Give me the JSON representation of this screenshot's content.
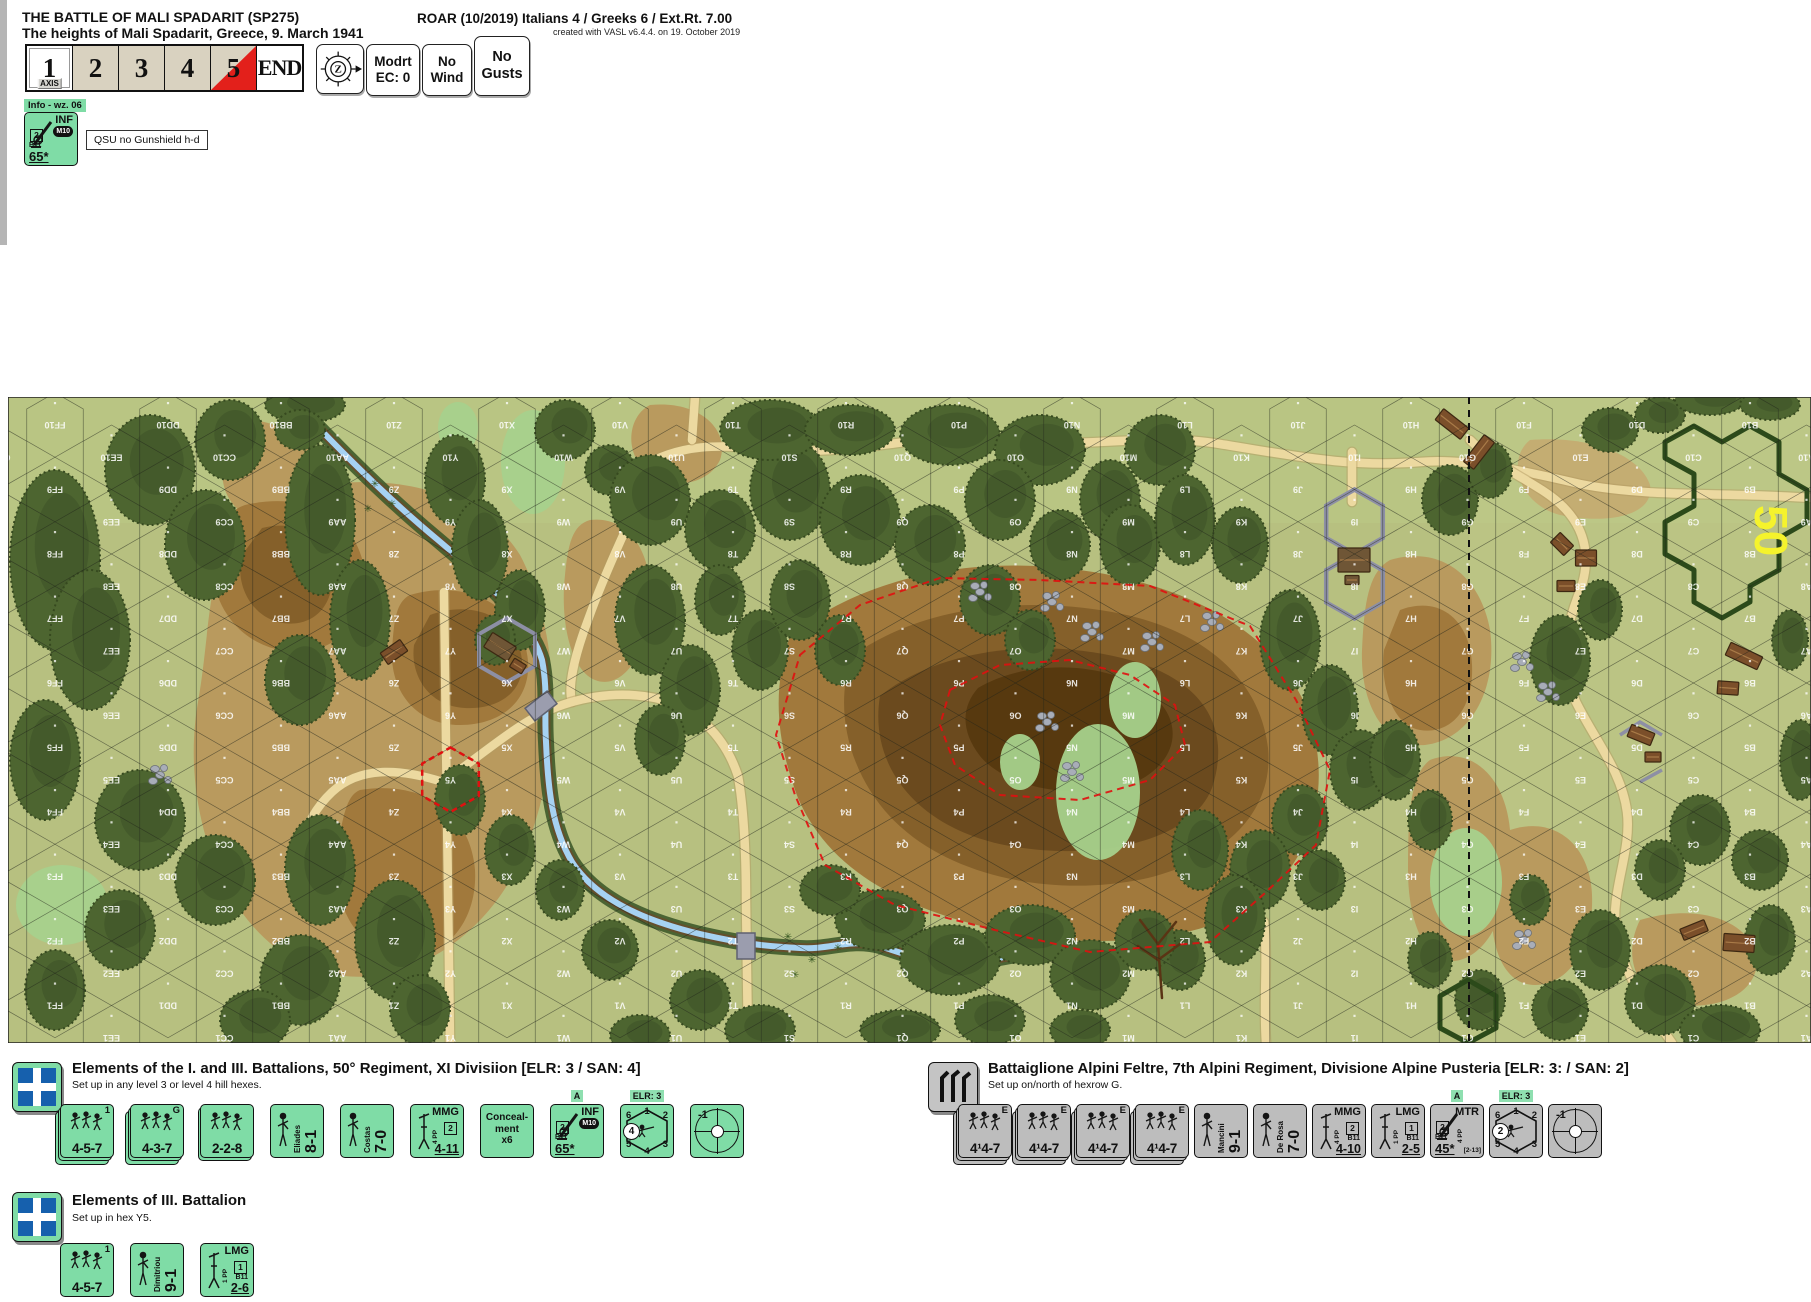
{
  "header": {
    "title": "THE BATTLE OF MALI SPADARIT (SP275)",
    "subtitle": "The heights of Mali Spadarit, Greece, 9. March 1941",
    "roar": "ROAR (10/2019) Italians 4 / Greeks 6 / Ext.Rt. 7.00",
    "created": "created with VASL v6.4.4. on 19. October 2019"
  },
  "turn_track": {
    "axis_label": "AXIS",
    "cells": [
      {
        "label": "1"
      },
      {
        "label": "2"
      },
      {
        "label": "3"
      },
      {
        "label": "4"
      },
      {
        "label": "5"
      },
      {
        "label": "END"
      }
    ],
    "compass_letter": "Z",
    "buttons": [
      {
        "lines": [
          "Modrt",
          "EC: 0"
        ]
      },
      {
        "lines": [
          "No",
          "Wind"
        ]
      },
      {
        "lines": [
          "No",
          "Gusts"
        ]
      }
    ]
  },
  "info_panel": {
    "tag": "Info - wz. 06",
    "counter": {
      "kind": "gun",
      "title": "INF",
      "cal": "M10",
      "box": "2",
      "sub": "B11",
      "value": "65*"
    },
    "note": "QSU  no Gunshield  h-d"
  },
  "map": {
    "board_number": "50",
    "columns": [
      "GG",
      "FF",
      "EE",
      "DD",
      "CC",
      "BB",
      "AA",
      "Z",
      "Y",
      "X",
      "W",
      "V",
      "U",
      "T",
      "S",
      "R",
      "Q",
      "P",
      "O",
      "N",
      "M",
      "L",
      "K",
      "J",
      "I",
      "H",
      "G",
      "F",
      "E",
      "D",
      "C",
      "B",
      "A"
    ],
    "rows": [
      10,
      9,
      8,
      7,
      6,
      5,
      4,
      3,
      2,
      1
    ],
    "highlight_hex": "Y5",
    "dice_ring": [
      "6",
      "1",
      "2",
      "5",
      "4",
      "3"
    ]
  },
  "sections": {
    "greek_main": {
      "title": "Elements of the I. and III. Battalions, 50° Regiment, XI Divisiion [ELR: 3 / SAN: 4]",
      "subtitle": "Set up in any level 3 or level 4 hill hexes.",
      "counters": [
        {
          "kind": "squad",
          "corner": "1",
          "value": "4-5-7",
          "stack": 3
        },
        {
          "kind": "squad",
          "corner": "G",
          "value": "4-3-7",
          "stack": 3
        },
        {
          "kind": "squad",
          "corner": "",
          "value": "2-2-8",
          "stack": 2
        },
        {
          "kind": "leader",
          "name": "Eliades",
          "value": "8-1"
        },
        {
          "kind": "leader",
          "name": "Costas",
          "value": "7-0"
        },
        {
          "kind": "sw",
          "title": "MMG",
          "pp": "4 PP",
          "box": "2",
          "value": "4-11"
        },
        {
          "kind": "note",
          "lines": [
            "Conceal-",
            "ment",
            "x6"
          ]
        },
        {
          "kind": "gun",
          "tag": "A",
          "title": "INF",
          "cal": "M10",
          "box": "2",
          "sub": "B11",
          "value": "65*"
        },
        {
          "kind": "dr",
          "tag": "ELR: 3",
          "circle": "4"
        },
        {
          "kind": "sniper",
          "value": "-1"
        }
      ]
    },
    "italian": {
      "title": "Battaiglione Alpini Feltre, 7th Alpini Regiment, Divisione Alpine Pusteria [ELR: 3: / SAN: 2]",
      "subtitle": "Set up on/north of hexrow G.",
      "counters": [
        {
          "kind": "squad",
          "corner": "E",
          "value": "4¹4-7",
          "stack": 3
        },
        {
          "kind": "squad",
          "corner": "E",
          "value": "4¹4-7",
          "stack": 3
        },
        {
          "kind": "squad",
          "corner": "E",
          "value": "4¹4-7",
          "stack": 3
        },
        {
          "kind": "squad",
          "corner": "E",
          "value": "4¹4-7",
          "stack": 3
        },
        {
          "kind": "leader",
          "name": "Mancini",
          "value": "9-1"
        },
        {
          "kind": "leader",
          "name": "De Rosa",
          "value": "7-0"
        },
        {
          "kind": "sw",
          "title": "MMG",
          "pp": "4 PP",
          "box": "2",
          "sub": "B11",
          "value": "4-10"
        },
        {
          "kind": "sw",
          "title": "LMG",
          "pp": "1 PP",
          "box": "1",
          "sub": "B11",
          "value": "2-5"
        },
        {
          "kind": "gun",
          "tag": "A",
          "title": "MTR",
          "pp": "4 PP",
          "box": "2",
          "sub": "B11",
          "value": "45*",
          "range": "[2-13]"
        },
        {
          "kind": "dr",
          "tag": "ELR: 3",
          "circle": "2"
        },
        {
          "kind": "sniper",
          "value": "-1"
        }
      ]
    },
    "greek_iii": {
      "title": "Elements of III. Battalion",
      "subtitle": "Set up in hex Y5.",
      "counters": [
        {
          "kind": "squad",
          "corner": "1",
          "value": "4-5-7",
          "stack": 1
        },
        {
          "kind": "leader",
          "name": "Dimitriou",
          "value": "9-1"
        },
        {
          "kind": "sw",
          "title": "LMG",
          "pp": "1 PP",
          "box": "1",
          "sub": "B11",
          "value": "2-6"
        }
      ]
    }
  }
}
